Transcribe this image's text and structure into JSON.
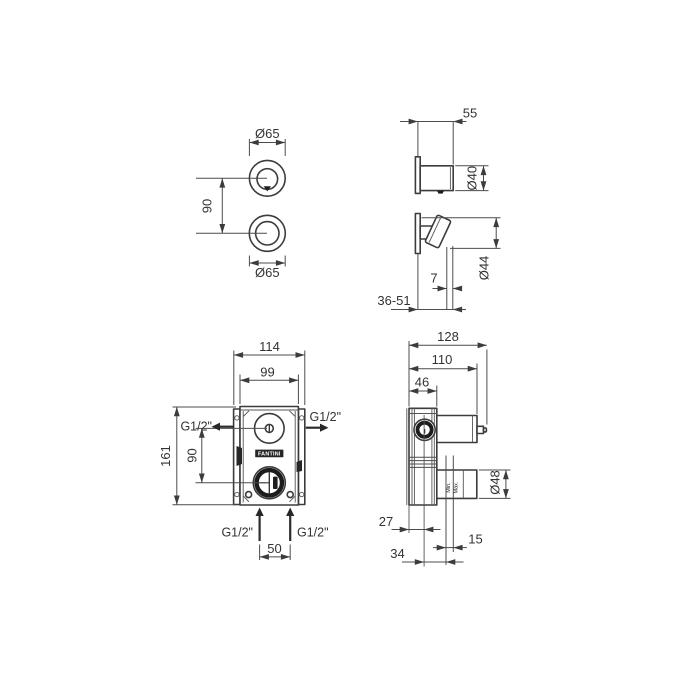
{
  "drawing": {
    "brand": "FANTINI",
    "background": "#ffffff",
    "line_color": "#3c3c3c",
    "views": {
      "trim_front": {
        "dims": {
          "top_knob_diameter": "Ø65",
          "knob_spacing": "90",
          "bottom_knob_diameter": "Ø65"
        }
      },
      "trim_side": {
        "dims": {
          "projection": "55",
          "top_knob_diameter": "Ø40",
          "lever_knob_diameter": "Ø44",
          "rosette_gap": "7",
          "wall_depth_range": "36-51"
        }
      },
      "body_front": {
        "dims": {
          "overall_width": "114",
          "body_width": "99",
          "overall_height": "161",
          "port_vertical_spacing": "90",
          "inlet_spacing": "50"
        },
        "ports": {
          "outlet_left": "G1/2\"",
          "outlet_right": "G1/2\"",
          "inlet_left": "G1/2\"",
          "inlet_right": "G1/2\""
        }
      },
      "body_side": {
        "dims": {
          "overall_depth": "128",
          "cartridge_depth": "110",
          "body_depth": "46",
          "axis_depth": "27",
          "centre_to_min": "34",
          "min_max_range": "15",
          "cartridge_diameter": "Ø48"
        },
        "labels": {
          "min": "Min.",
          "max": "Max."
        }
      }
    }
  }
}
